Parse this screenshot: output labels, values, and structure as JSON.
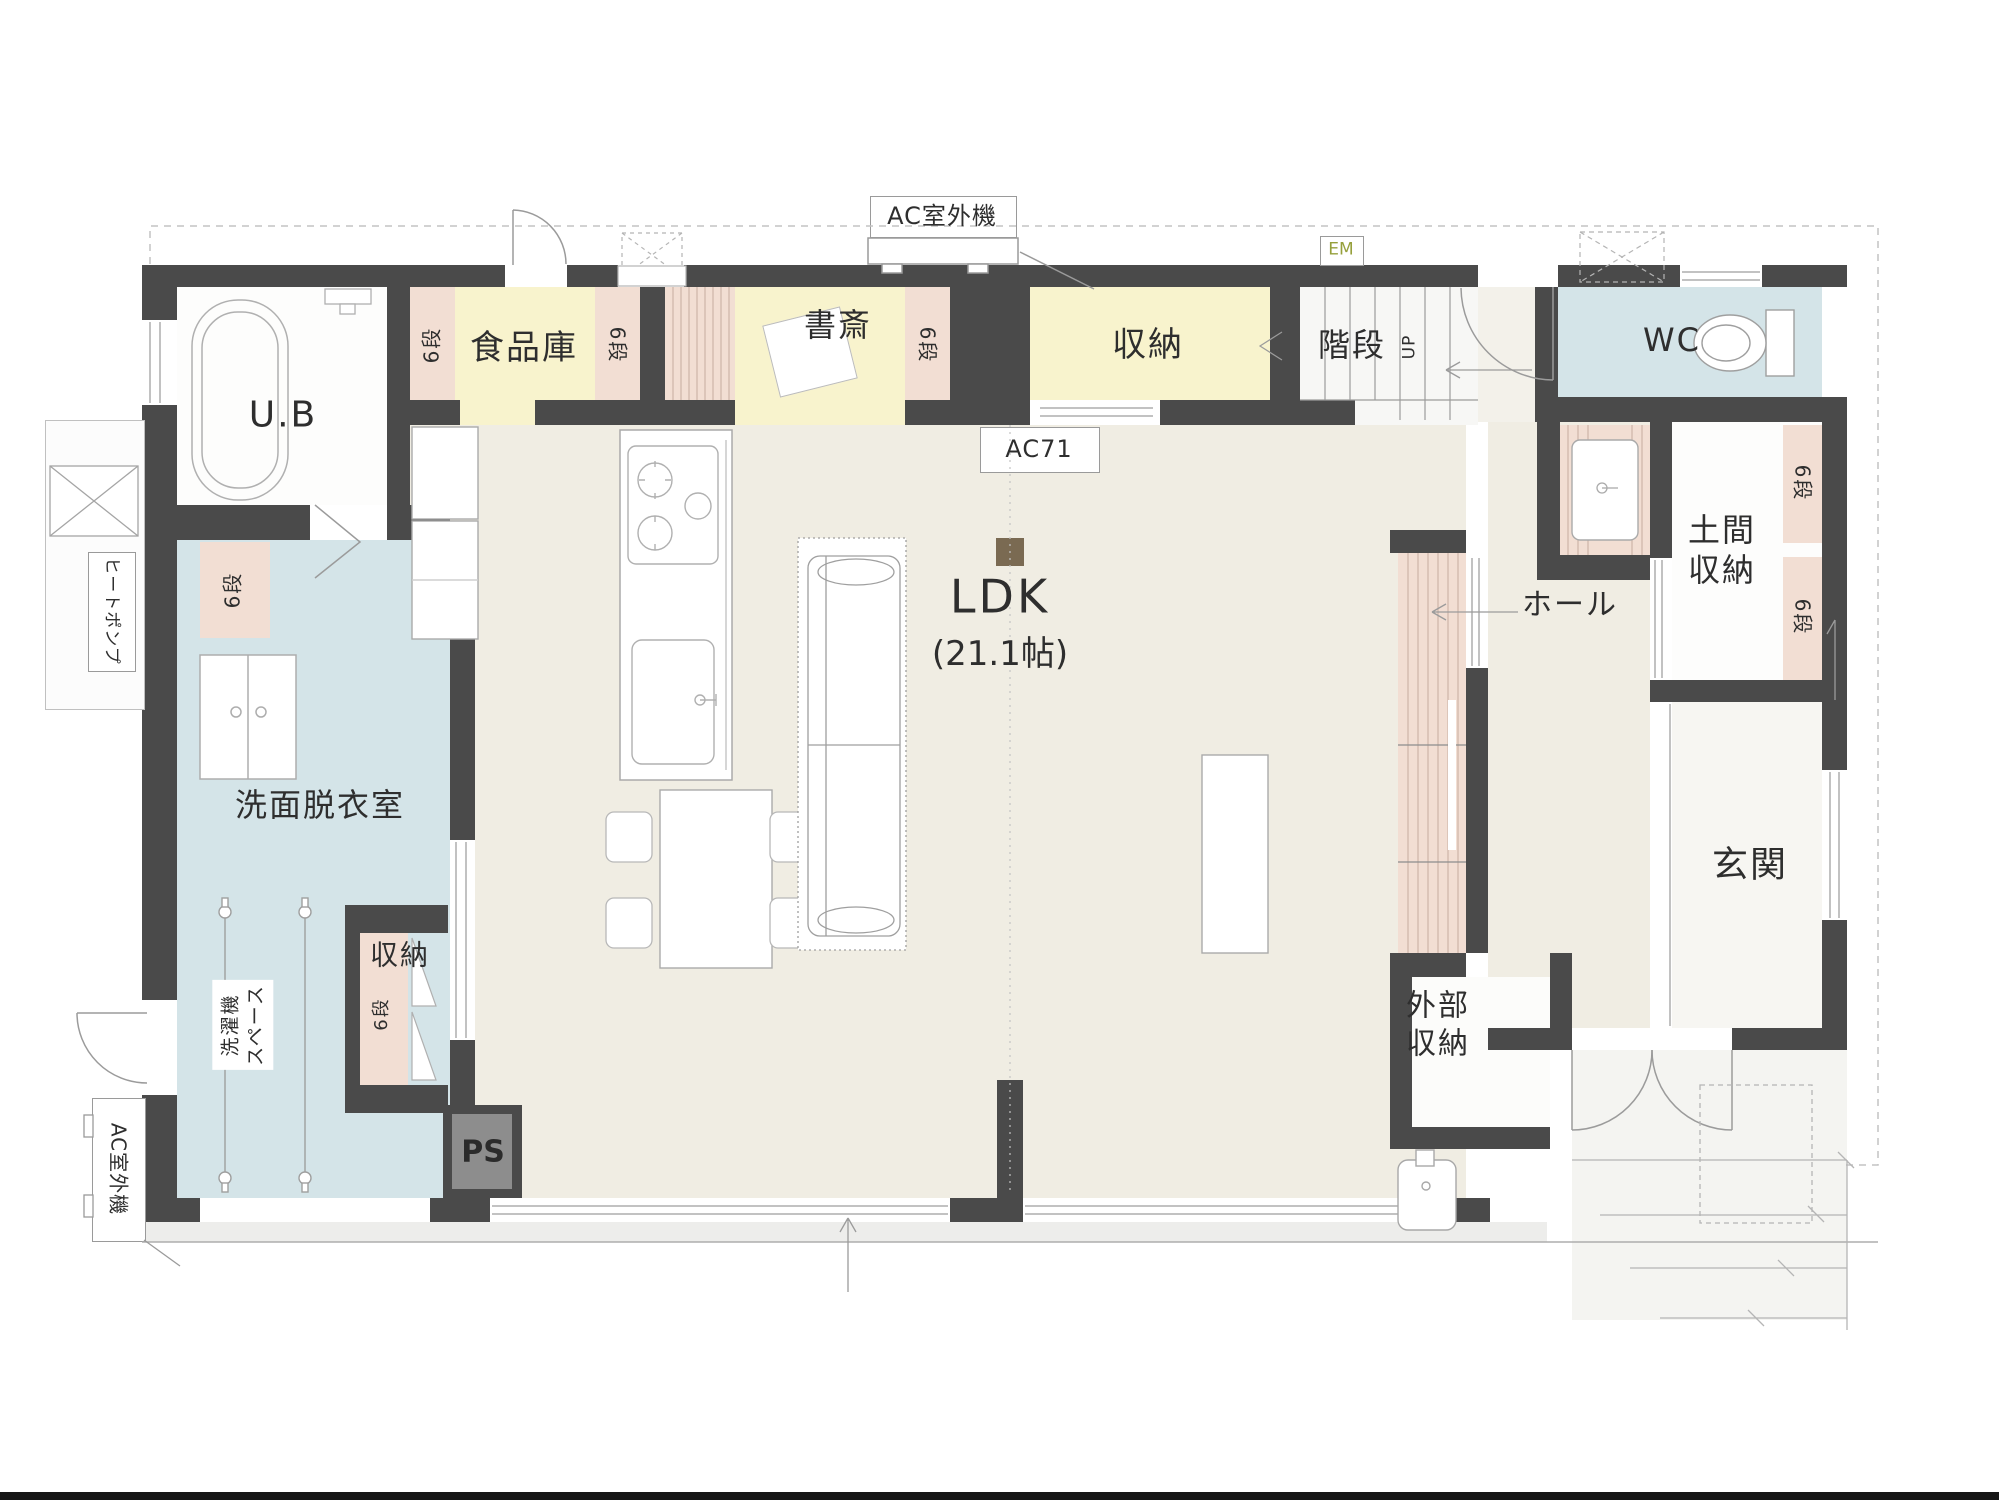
{
  "type": "floor-plan",
  "colors": {
    "wall": "#4a4a4a",
    "floor_beige": "#f0ede3",
    "room_yellow": "#f8f3cd",
    "shelf_pink": "#f2ded3",
    "room_blue": "#d4e4e8",
    "room_white": "#fdfdfc",
    "em_green": "#96a03c",
    "pillar_brown": "#7a6a52"
  },
  "labels": {
    "ub": "U.B",
    "pantry": "食品庫",
    "study": "書斎",
    "storage_top": "収納",
    "stairs": "階段",
    "up": "UP",
    "em": "EM",
    "wc": "WC",
    "ac_outdoor": "AC室外機",
    "ac71": "AC71",
    "ldk": "LDK",
    "ldk_size": "(21.1帖)",
    "hall": "ホール",
    "doma_storage": "土間\n収納",
    "genkan": "玄関",
    "washroom": "洗面脱衣室",
    "laundry_space": "洗濯機\nスペース",
    "heatpump": "ヒートポンプ",
    "storage_bottom": "収納",
    "gaibu_storage": "外部\n収納",
    "ps": "PS",
    "fridge": "冷",
    "six_dan": "6段"
  }
}
